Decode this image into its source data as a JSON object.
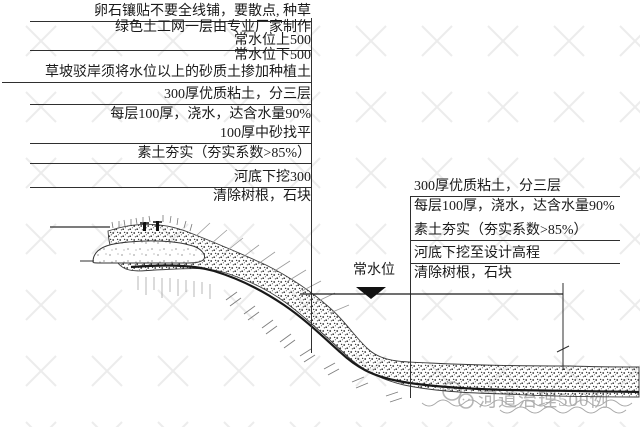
{
  "left_callout": {
    "rows": [
      "卵石镶贴不要全线铺，要散点, 种草",
      "绿色土工网一层由专业厂家制作",
      "常水位上500",
      "常水位下500",
      "草坡驳岸须将水位以上的砂质土掺加种植土",
      "300厚优质粘土，分三层",
      "每层100厚，浇水，达含水量90%",
      "100厚中砂找平",
      "素土夯实（夯实系数>85%）",
      "河底下挖300",
      "清除树根，石块"
    ]
  },
  "right_callout": {
    "rows": [
      "300厚优质粘土，分三层",
      "每层100厚，浇水，达含水量90%",
      "素土夯实（夯实系数>85%）",
      "河底下挖至设计高程",
      "清除树根，石块"
    ]
  },
  "water_level_label": "常水位",
  "watermark": {
    "text": "河道治理500例",
    "logo": "wechat-icon"
  },
  "colors": {
    "line": "#333333",
    "dark_layer": "#1a1a1a",
    "watermark_text": "#b4b4b4",
    "background": "#ffffff"
  }
}
